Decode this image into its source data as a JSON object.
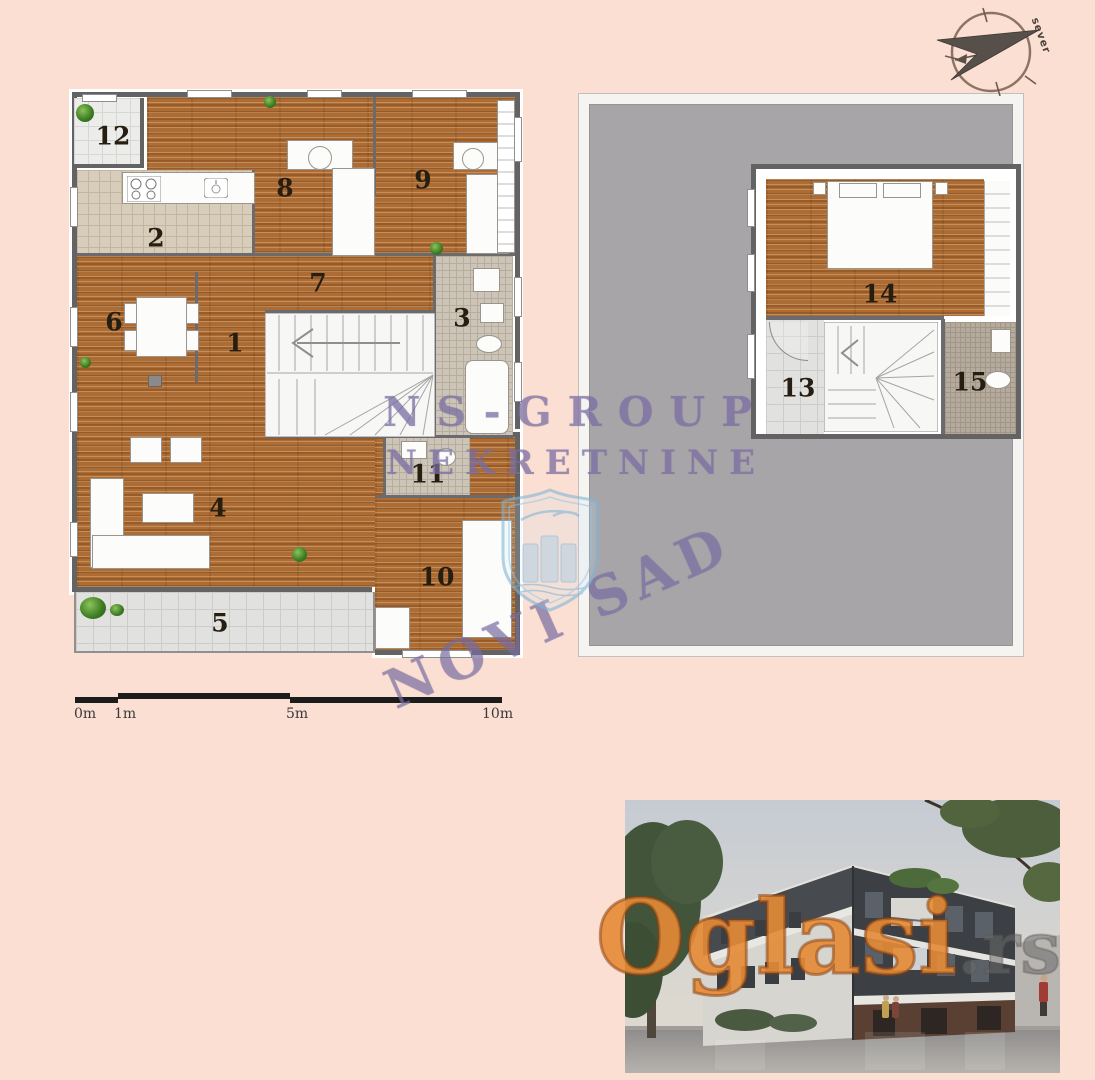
{
  "colors": {
    "background": "#fbdfd2",
    "wood": "#ad6c33",
    "roof_gray": "#a8a5a9",
    "wall_gray": "#636363",
    "watermark_purple": "#8274aa",
    "oglasi_orange": "#ec903a"
  },
  "compass": {
    "label": "sever"
  },
  "plan1": {
    "label": "ground floor plan",
    "rooms": [
      {
        "number": "1"
      },
      {
        "number": "2"
      },
      {
        "number": "3"
      },
      {
        "number": "4"
      },
      {
        "number": "5"
      },
      {
        "number": "6"
      },
      {
        "number": "7"
      },
      {
        "number": "8"
      },
      {
        "number": "9"
      },
      {
        "number": "10"
      },
      {
        "number": "11"
      },
      {
        "number": "12"
      }
    ]
  },
  "plan2": {
    "label": "upper floor plan",
    "rooms": [
      {
        "number": "13"
      },
      {
        "number": "14"
      },
      {
        "number": "15"
      }
    ]
  },
  "scalebar": {
    "labels": [
      "0m",
      "1m",
      "5m",
      "10m"
    ]
  },
  "watermark": {
    "line1": "NS-GROUP",
    "line2": "NEKRETNINE",
    "line3": "NOVI SAD"
  },
  "photo": {
    "watermark_text": "Oglasi",
    "watermark_suffix": ".rs"
  }
}
